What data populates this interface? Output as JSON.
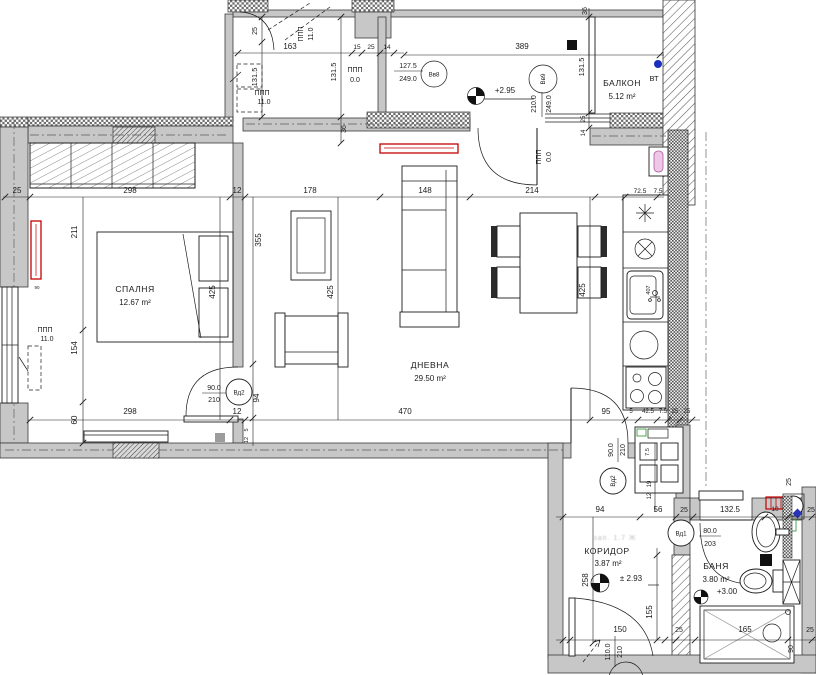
{
  "plan": {
    "rooms": {
      "bedroom": {
        "name": "СПАЛНЯ",
        "area": "12.67 m²"
      },
      "living": {
        "name": "ДНЕВНА",
        "area": "29.50 m²"
      },
      "balcony": {
        "name": "БАЛКОН",
        "area": "5.12 m²"
      },
      "corridor": {
        "name": "КОРИДОР",
        "area": "3.87 m²"
      },
      "bath": {
        "name": "БАНЯ",
        "area": "3.80 m²"
      }
    },
    "levels": {
      "living": "+2.95",
      "corridor": "± 2.93",
      "bath": "+3.00"
    },
    "tags": {
      "vv8": "Вв8",
      "vv9": "Вв9",
      "vd1": "Вд1",
      "vd2": "Вд2"
    },
    "openings": {
      "vv8": {
        "w": "127.5",
        "h": "249.0"
      },
      "vv9": {
        "w": "210.0",
        "h": "249.0"
      },
      "vd2": {
        "w": "90.0",
        "h": "210"
      },
      "vd1": {
        "w": "80.0",
        "h": "203"
      },
      "entrance": {
        "w": "110.0",
        "h": "210"
      }
    },
    "labels": {
      "ppp": "ППП",
      "v11": "11.0",
      "v0": "0.0",
      "vt": "ВТ",
      "stamp": "зап. 1.7 Ж",
      "sink_code": "407"
    },
    "dims": {
      "v5": "5",
      "v7_5": "7.5",
      "v10": "10",
      "v12": "12",
      "v14": "14",
      "v15": "15",
      "v19": "19",
      "v25": "25",
      "v36": "36",
      "v42_5": "42.5",
      "v56": "56",
      "v60": "60",
      "v72_5": "72.5",
      "v80": "80.0",
      "v90": "90",
      "v90_0": "90.0",
      "v94": "94",
      "v95": "95",
      "v110": "110.0",
      "v127_5": "127.5",
      "v131_5": "131.5",
      "v132_5": "132.5",
      "v148": "148",
      "v150": "150",
      "v154": "154",
      "v155": "155",
      "v163": "163",
      "v165": "165",
      "v178": "178",
      "v203": "203",
      "v210": "210",
      "v210_0": "210.0",
      "v211": "211",
      "v214": "214",
      "v249": "249.0",
      "v258": "258",
      "v298": "298",
      "v355": "355",
      "v389": "389",
      "v425": "425",
      "v470": "470"
    }
  }
}
